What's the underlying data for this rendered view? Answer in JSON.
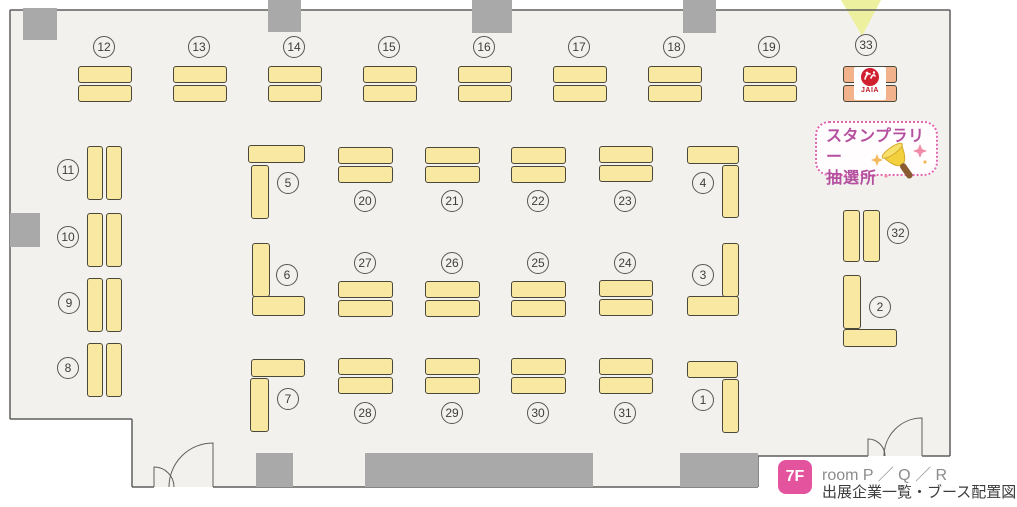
{
  "legend": {
    "floor_badge": "7F",
    "room_line": "room P ／ Q ／ R",
    "subtitle_line": "出展企業一覧・ブース配置図"
  },
  "stamp_rally": {
    "line1": "スタンプラリー",
    "line2": "抽選所",
    "icon": "handbell-icon"
  },
  "colors": {
    "floor": "#f2f1ed",
    "wall": "#5f5f5f",
    "table_fill": "#f9e8a2",
    "table_border": "#4a4839",
    "pillar": "#a9a9a9",
    "booth33_fill": "#f2b28c",
    "arrow": "#edf09e",
    "badge_pink": "#e4549e",
    "stamp_text": "#b5509f",
    "stamp_border": "#e066b0",
    "logo_red": "#c01828"
  },
  "floorplan": {
    "floor_points": "10,10 950,10 950,456 758,456 758,487 132,487 132,419 10,419",
    "arrow_points": "841,0 881,0 862,36",
    "walls": [
      [
        10,
        10,
        950,
        10
      ],
      [
        10,
        10,
        10,
        419
      ],
      [
        10,
        419,
        132,
        419
      ],
      [
        132,
        419,
        132,
        487
      ],
      [
        132,
        487,
        154,
        487
      ],
      [
        213,
        487,
        758,
        487
      ],
      [
        758,
        456,
        758,
        487
      ],
      [
        758,
        456,
        868,
        456
      ],
      [
        922,
        456,
        950,
        456
      ],
      [
        950,
        10,
        950,
        456
      ]
    ],
    "door_paths": [
      "M213,487 L213,443 A44 44 0 0 0 169,487",
      "M154,487 L154,467 A20 20 0 0 1 174,487",
      "M922,456 L922,418 A38 38 0 0 0 884,456",
      "M868,456 L868,439 A17 17 0 0 1 885,456"
    ],
    "pillars": [
      [
        23,
        8,
        34,
        32
      ],
      [
        268,
        0,
        33,
        32
      ],
      [
        472,
        0,
        40,
        33
      ],
      [
        683,
        0,
        33,
        33
      ],
      [
        10,
        213,
        30,
        34
      ],
      [
        256,
        453,
        37,
        34
      ],
      [
        365,
        453,
        228,
        34
      ],
      [
        680,
        453,
        78,
        34
      ]
    ],
    "booths": [
      {
        "label": "12",
        "tables": [
          [
            78,
            66,
            54,
            17
          ],
          [
            78,
            85,
            54,
            17
          ]
        ],
        "circle": [
          104,
          47
        ]
      },
      {
        "label": "13",
        "tables": [
          [
            173,
            66,
            54,
            17
          ],
          [
            173,
            85,
            54,
            17
          ]
        ],
        "circle": [
          199,
          47
        ]
      },
      {
        "label": "14",
        "tables": [
          [
            268,
            66,
            54,
            17
          ],
          [
            268,
            85,
            54,
            17
          ]
        ],
        "circle": [
          294,
          47
        ]
      },
      {
        "label": "15",
        "tables": [
          [
            363,
            66,
            54,
            17
          ],
          [
            363,
            85,
            54,
            17
          ]
        ],
        "circle": [
          389,
          47
        ]
      },
      {
        "label": "16",
        "tables": [
          [
            458,
            66,
            54,
            17
          ],
          [
            458,
            85,
            54,
            17
          ]
        ],
        "circle": [
          484,
          47
        ]
      },
      {
        "label": "17",
        "tables": [
          [
            553,
            66,
            54,
            17
          ],
          [
            553,
            85,
            54,
            17
          ]
        ],
        "circle": [
          579,
          47
        ]
      },
      {
        "label": "18",
        "tables": [
          [
            648,
            66,
            54,
            17
          ],
          [
            648,
            85,
            54,
            17
          ]
        ],
        "circle": [
          674,
          47
        ]
      },
      {
        "label": "19",
        "tables": [
          [
            743,
            66,
            54,
            17
          ],
          [
            743,
            85,
            54,
            17
          ]
        ],
        "circle": [
          769,
          47
        ]
      },
      {
        "label": "33",
        "tables": [
          [
            843,
            66,
            54,
            17
          ],
          [
            843,
            85,
            54,
            17
          ]
        ],
        "circle": [
          866,
          45
        ],
        "fill": "#f2b28c",
        "logo_text": "JAIA"
      },
      {
        "label": "11",
        "tables": [
          [
            87,
            146,
            16,
            54
          ],
          [
            106,
            146,
            16,
            54
          ]
        ],
        "circle": [
          68,
          170
        ]
      },
      {
        "label": "10",
        "tables": [
          [
            87,
            213,
            16,
            54
          ],
          [
            106,
            213,
            16,
            54
          ]
        ],
        "circle": [
          68,
          237
        ]
      },
      {
        "label": "9",
        "tables": [
          [
            87,
            278,
            16,
            54
          ],
          [
            106,
            278,
            16,
            54
          ]
        ],
        "circle": [
          69,
          303
        ]
      },
      {
        "label": "8",
        "tables": [
          [
            87,
            343,
            16,
            54
          ],
          [
            106,
            343,
            16,
            54
          ]
        ],
        "circle": [
          68,
          368
        ]
      },
      {
        "label": "5",
        "tables": [
          [
            248,
            145,
            57,
            18
          ],
          [
            251,
            165,
            18,
            54
          ]
        ],
        "circle": [
          288,
          183
        ]
      },
      {
        "label": "20",
        "tables": [
          [
            338,
            147,
            55,
            17
          ],
          [
            338,
            166,
            55,
            17
          ]
        ],
        "circle": [
          365,
          201
        ]
      },
      {
        "label": "21",
        "tables": [
          [
            425,
            147,
            55,
            17
          ],
          [
            425,
            166,
            55,
            17
          ]
        ],
        "circle": [
          452,
          201
        ]
      },
      {
        "label": "22",
        "tables": [
          [
            511,
            147,
            55,
            17
          ],
          [
            511,
            166,
            55,
            17
          ]
        ],
        "circle": [
          538,
          201
        ]
      },
      {
        "label": "23",
        "tables": [
          [
            599,
            146,
            54,
            17
          ],
          [
            599,
            165,
            54,
            17
          ]
        ],
        "circle": [
          625,
          201
        ]
      },
      {
        "label": "4",
        "tables": [
          [
            687,
            146,
            52,
            18
          ],
          [
            722,
            165,
            17,
            53
          ]
        ],
        "circle": [
          703,
          183
        ]
      },
      {
        "label": "6",
        "tables": [
          [
            252,
            243,
            18,
            54
          ],
          [
            252,
            296,
            53,
            20
          ]
        ],
        "circle": [
          287,
          275
        ]
      },
      {
        "label": "27",
        "tables": [
          [
            338,
            281,
            55,
            17
          ],
          [
            338,
            300,
            55,
            17
          ]
        ],
        "circle": [
          365,
          263
        ]
      },
      {
        "label": "26",
        "tables": [
          [
            425,
            281,
            55,
            17
          ],
          [
            425,
            300,
            55,
            17
          ]
        ],
        "circle": [
          452,
          263
        ]
      },
      {
        "label": "25",
        "tables": [
          [
            511,
            281,
            55,
            17
          ],
          [
            511,
            300,
            55,
            17
          ]
        ],
        "circle": [
          538,
          263
        ]
      },
      {
        "label": "24",
        "tables": [
          [
            599,
            280,
            54,
            17
          ],
          [
            599,
            299,
            54,
            17
          ]
        ],
        "circle": [
          625,
          263
        ]
      },
      {
        "label": "3",
        "tables": [
          [
            722,
            243,
            17,
            54
          ],
          [
            687,
            296,
            52,
            20
          ]
        ],
        "circle": [
          703,
          275
        ]
      },
      {
        "label": "32",
        "tables": [
          [
            843,
            210,
            17,
            52
          ],
          [
            863,
            210,
            17,
            52
          ]
        ],
        "circle": [
          898,
          233
        ]
      },
      {
        "label": "2",
        "tables": [
          [
            843,
            275,
            18,
            54
          ],
          [
            843,
            329,
            54,
            18
          ]
        ],
        "circle": [
          880,
          307
        ]
      },
      {
        "label": "7",
        "tables": [
          [
            251,
            359,
            54,
            18
          ],
          [
            250,
            378,
            19,
            54
          ]
        ],
        "circle": [
          288,
          399
        ]
      },
      {
        "label": "28",
        "tables": [
          [
            338,
            358,
            55,
            17
          ],
          [
            338,
            377,
            55,
            17
          ]
        ],
        "circle": [
          365,
          413
        ]
      },
      {
        "label": "29",
        "tables": [
          [
            425,
            358,
            55,
            17
          ],
          [
            425,
            377,
            55,
            17
          ]
        ],
        "circle": [
          452,
          413
        ]
      },
      {
        "label": "30",
        "tables": [
          [
            511,
            358,
            55,
            17
          ],
          [
            511,
            377,
            55,
            17
          ]
        ],
        "circle": [
          538,
          413
        ]
      },
      {
        "label": "31",
        "tables": [
          [
            599,
            358,
            54,
            17
          ],
          [
            599,
            377,
            54,
            17
          ]
        ],
        "circle": [
          625,
          413
        ]
      },
      {
        "label": "1",
        "tables": [
          [
            687,
            361,
            51,
            17
          ],
          [
            722,
            379,
            17,
            54
          ]
        ],
        "circle": [
          703,
          400
        ]
      }
    ]
  }
}
